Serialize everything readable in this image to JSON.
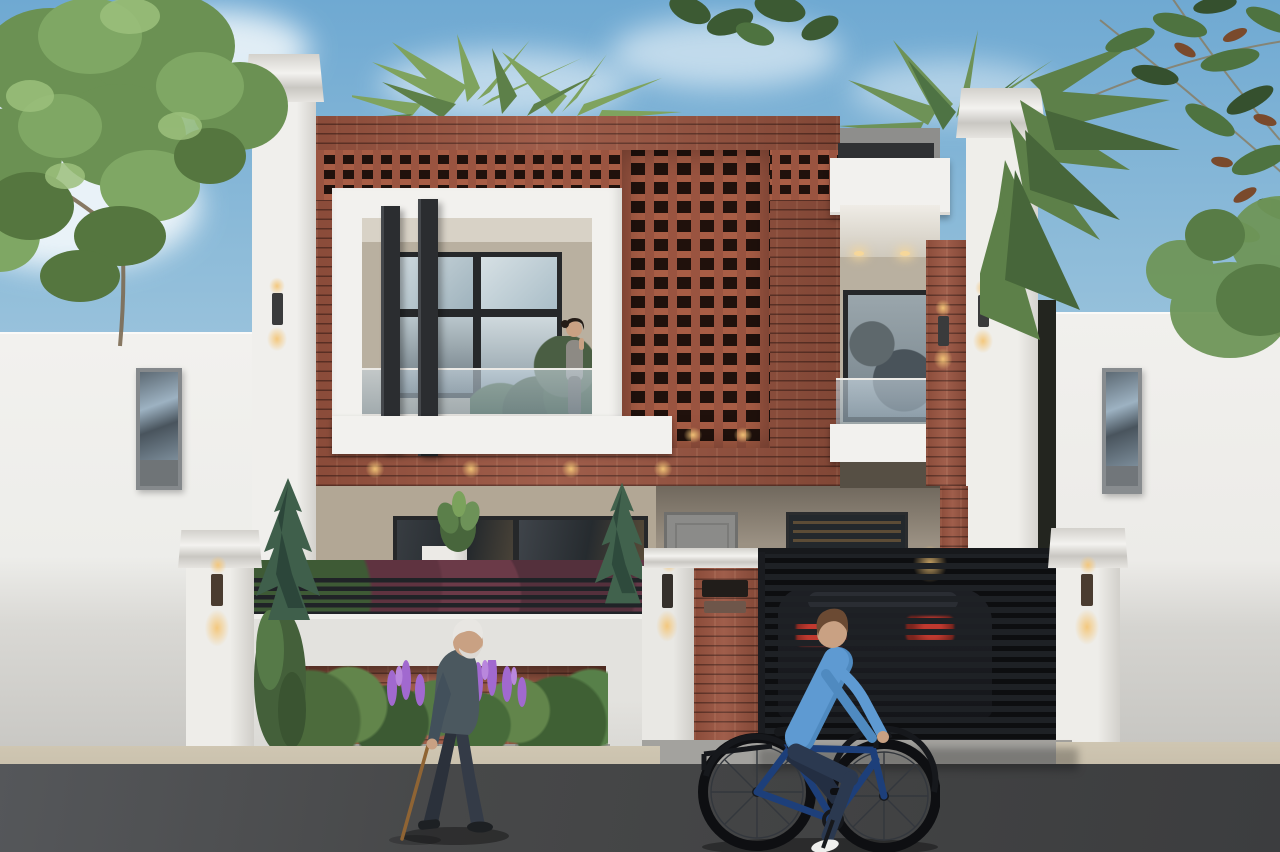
{
  "meta": {
    "type": "architectural-exterior-render",
    "caption": "Photorealistic render of a modern two-storey house: white plaster piers and fascias with a red-brick facade and a perforated brick jali screen, glass balcony railings, dark vertical fins, a slatted dark driveway gate with a parked dark car behind it, landscaped planter with purple lupine flowers and conifers, an elderly man walking with a cane and a man in a blue shirt cycling past on the asphalt road, leafy trees and palm fronds framing a blue sky."
  },
  "colors": {
    "sky_top": "#6fa9d2",
    "sky_mid": "#a9cbe0",
    "cloud": "#f4f9fc",
    "foliage_dark": "#35502e",
    "foliage": "#4e7340",
    "foliage_light": "#7ba25c",
    "palm": "#5d8049",
    "palm_light": "#82a763",
    "pod_brown": "#7a4a2c",
    "branch": "#8a7a5e",
    "brick": "#9a5440",
    "brick_light": "#a85d45",
    "jali_hole": "#20110c",
    "trim_white": "#f2f1ee",
    "trim_shadow": "#d7d5d0",
    "left_wall": "#f0efec",
    "wall_gray": "#c7c6c2",
    "beige_wall": "#b2a795",
    "porch_beige": "#9b9183",
    "interior_beige": "#b9b0a0",
    "ceiling_beige": "#d8d2c6",
    "frame_dark": "#26282a",
    "fin_dark": "#2b2d30",
    "window_dark": "#23282c",
    "door_gray": "#8b8b89",
    "blind_warm": "#8a6a3e",
    "fence_dark": "#202327",
    "gate_dark": "#1e2125",
    "hedge_burgundy": "#5f3340",
    "conifer": "#3f5f4b",
    "conifer_dark": "#2c463a",
    "flower_purple": "#a169cf",
    "curb_gray": "#9d9c98",
    "sidewalk": "#c8bfab",
    "road": "#474849",
    "apron": "#a3a29e",
    "lamp_glow": "#f0c27c",
    "lamp_body": "#3a3b3c",
    "car_dark": "#141519",
    "taillight": "#c0392f",
    "skin": "#c9a183",
    "hair_white": "#e8e6e2",
    "hair_brown": "#6b4a33",
    "jacket_gray": "#4b585f",
    "dark_pants": "#2f3540",
    "shirt_blue": "#5e9ad2",
    "pants_navy": "#2b3950",
    "shoe_white": "#efefed",
    "bike_blue": "#1d3f7a",
    "tire_black": "#0e0f12",
    "woman_hair": "#241c17",
    "woman_top": "#8d8a84"
  },
  "scene_objects": [
    {
      "name": "sky",
      "desc": "blue sky with soft white clouds"
    },
    {
      "name": "left-tree",
      "desc": "leafy green tree over left boundary wall"
    },
    {
      "name": "right-foliage",
      "desc": "palm fronds and leafy branches with brown seed pods"
    },
    {
      "name": "house",
      "desc": "two-storey modern house, brick facade with perforated jali screen"
    },
    {
      "name": "left-balcony",
      "desc": "white-framed balcony with glass railing and two dark vertical fins"
    },
    {
      "name": "balcony-woman",
      "desc": "woman standing on the first-floor balcony"
    },
    {
      "name": "right-balcony",
      "desc": "recessed balcony with picture window and glass railing"
    },
    {
      "name": "compound-wall",
      "desc": "white front wall, dark slat fence, brick planter with shrubs and purple lupines"
    },
    {
      "name": "driveway-gate",
      "desc": "dark horizontal-slat gate with dark car parked behind"
    },
    {
      "name": "wall-lamps",
      "desc": "warm up/down wall sconces on piers and gate pillar"
    },
    {
      "name": "elderly-pedestrian",
      "desc": "white-haired man in dark jacket walking with a cane"
    },
    {
      "name": "cyclist",
      "desc": "man in blue shirt and navy trousers riding a dark blue bicycle"
    },
    {
      "name": "road",
      "desc": "dark asphalt road with beige sidewalk strip"
    }
  ]
}
